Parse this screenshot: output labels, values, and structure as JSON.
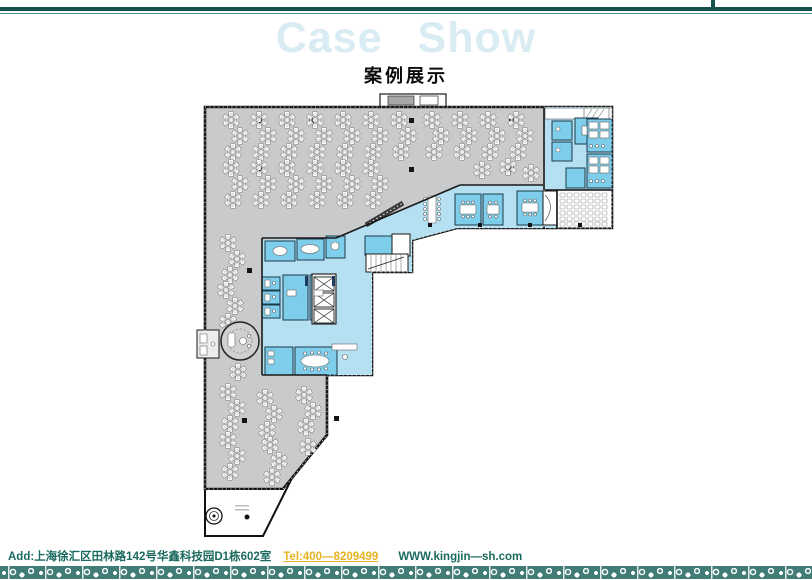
{
  "header": {
    "title_en": "Case Show",
    "title_zh": "案例展示"
  },
  "footer": {
    "address": "Add:上海徐汇区田林路142号华鑫科技园D1栋602室",
    "tel": "Tel:400—8209499",
    "website": "WWW.kingjin—sh.com"
  },
  "colors": {
    "accent_dark": "#17504c",
    "accent_light": "#4d8a84",
    "title_fill": "#d9ecf3",
    "footer_text": "#1a6a5f",
    "tel_yellow": "#e5b31e",
    "strip_teal": "#417c77",
    "plan_gray": "#c9cacc",
    "plan_light_blue": "#b5e0f1",
    "plan_mid_blue": "#7ecdea",
    "plan_wall": "#1a1a1a"
  },
  "floor_plan": {
    "description": "office floor plan",
    "zones": [
      "open-office",
      "meeting-rooms",
      "reception-hall",
      "elevator-core",
      "training-room",
      "restrooms",
      "phone-booths",
      "spiral-lounge",
      "terrace"
    ]
  }
}
